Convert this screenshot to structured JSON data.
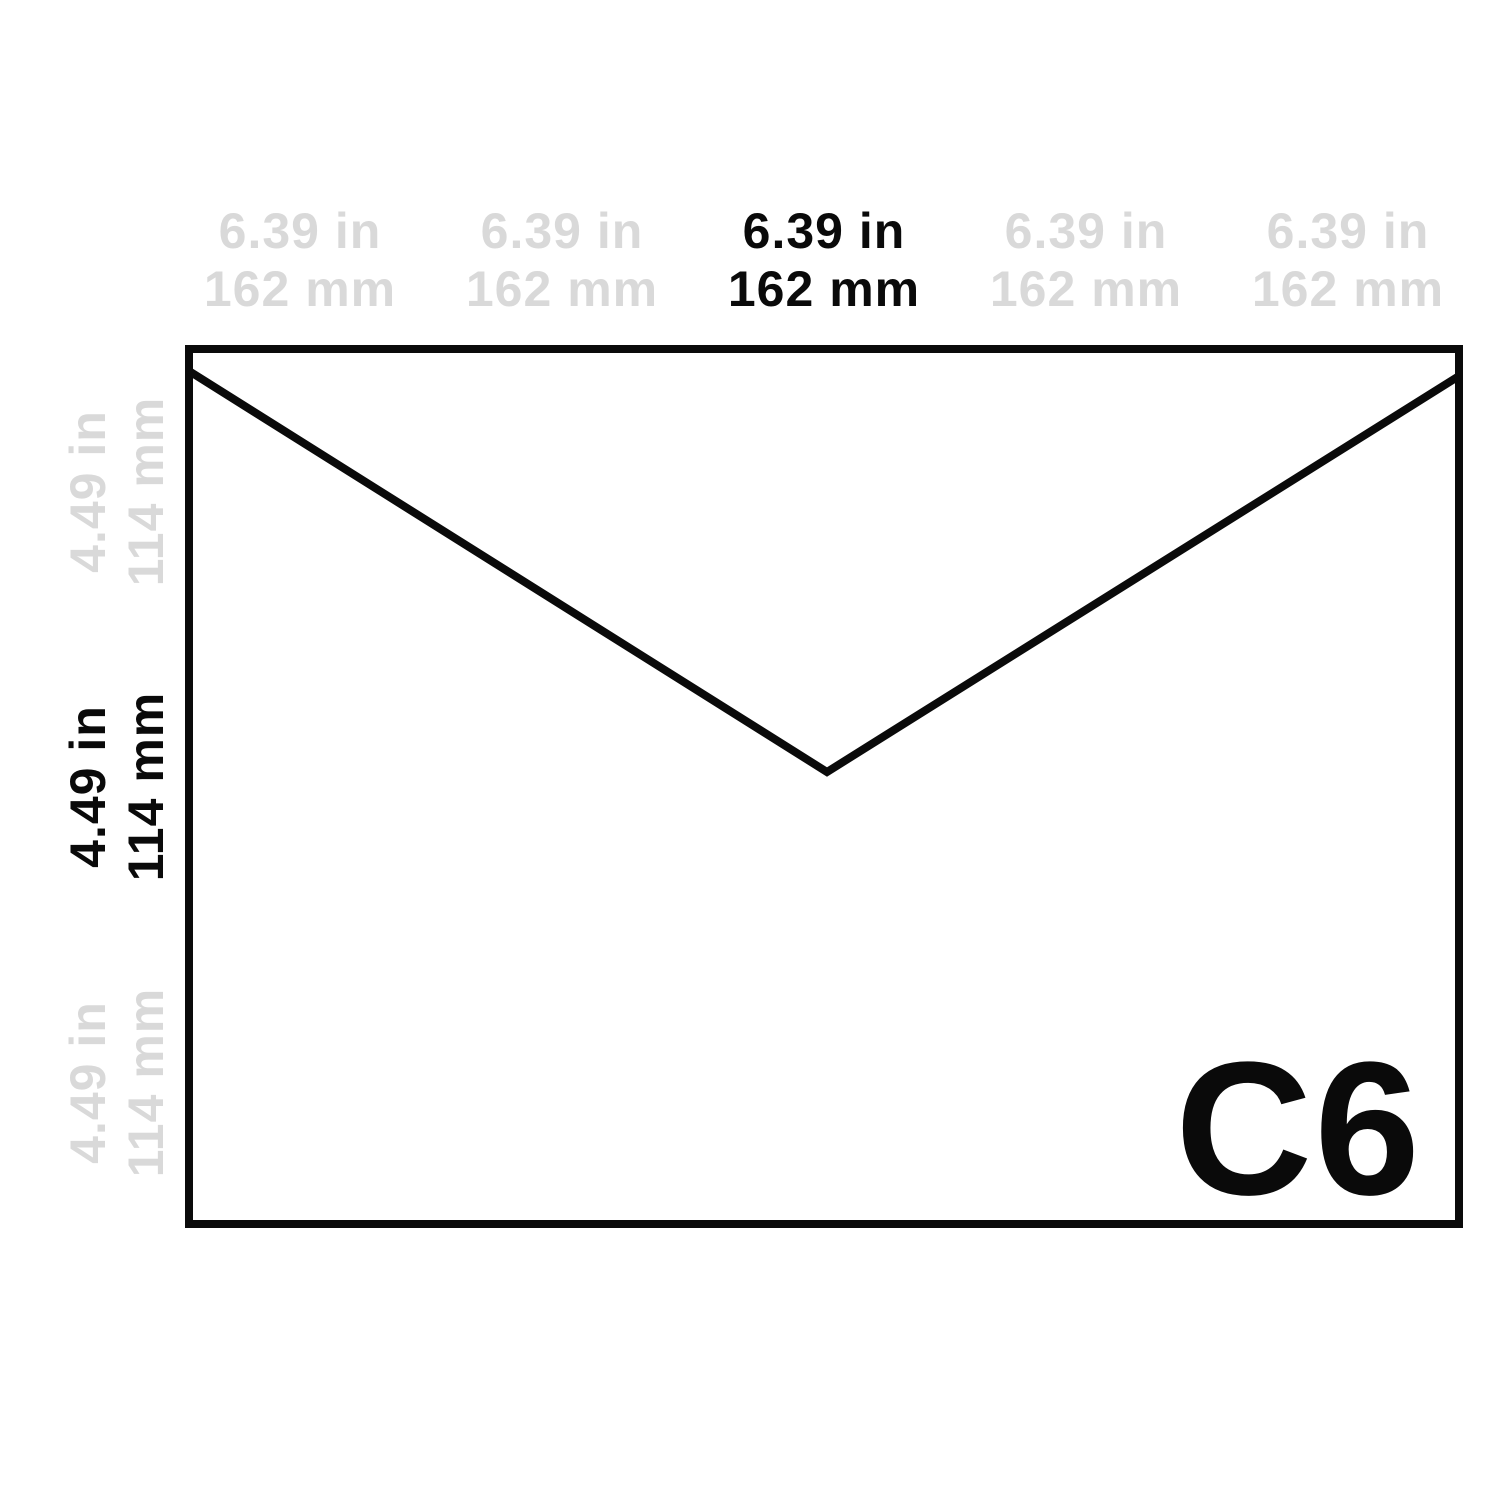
{
  "colors": {
    "background": "#ffffff",
    "outline": "#0a0a0a",
    "ink": "#0a0a0a",
    "ghost": "#d9d9d9"
  },
  "envelope": {
    "name": "C6",
    "shape": "envelope-with-v-flap",
    "width_in": "6.39 in",
    "width_mm": "162 mm",
    "height_in": "4.49 in",
    "height_mm": "114 mm"
  },
  "top_labels": [
    {
      "in": "6.39 in",
      "mm": "162 mm",
      "emphasized": false
    },
    {
      "in": "6.39 in",
      "mm": "162 mm",
      "emphasized": false
    },
    {
      "in": "6.39 in",
      "mm": "162 mm",
      "emphasized": true
    },
    {
      "in": "6.39 in",
      "mm": "162 mm",
      "emphasized": false
    },
    {
      "in": "6.39 in",
      "mm": "162 mm",
      "emphasized": false
    }
  ],
  "side_labels": [
    {
      "in": "4.49 in",
      "mm": "114 mm",
      "emphasized": false
    },
    {
      "in": "4.49 in",
      "mm": "114 mm",
      "emphasized": true
    },
    {
      "in": "4.49 in",
      "mm": "114 mm",
      "emphasized": false
    }
  ]
}
